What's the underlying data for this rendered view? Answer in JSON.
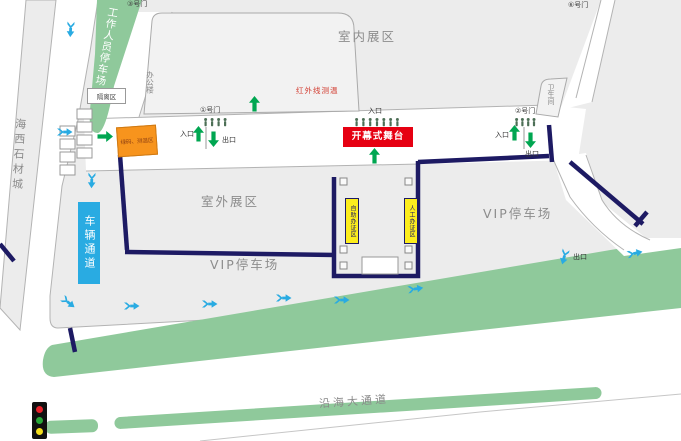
{
  "areas": {
    "stone_city": "海西石材城",
    "staff_parking": "工作人员停车场",
    "isolation_zone": "隔离区",
    "office_building": "办公楼",
    "indoor_exhibition": "室内展区",
    "outdoor_exhibition": "室外展区",
    "vip_parking": "VIP停车场",
    "restroom": "卫生间",
    "coastal_road": "沿海大通道"
  },
  "gates": {
    "gate1": "①号门",
    "gate2": "②号门",
    "gate3": "③号门",
    "gate6": "⑥号门"
  },
  "flow": {
    "entrance": "入口",
    "exit": "出口"
  },
  "facilities": {
    "stage": "开幕式舞台",
    "green_code_zone": "绿码、测温区",
    "infrared_check": "红外线测温",
    "vehicle_channel": "车辆通道",
    "self_service_badge_zone": "自助办证区",
    "manual_badge_zone": "人工办证区"
  },
  "colors": {
    "route_navy": "#1d1a63",
    "arrow_blue": "#29abe2",
    "arrow_green": "#00a651",
    "zone_green": "#8fc99b",
    "stage_red": "#e60012",
    "checkpoint_orange": "#f7941d",
    "badge_yellow": "#fced1e"
  }
}
